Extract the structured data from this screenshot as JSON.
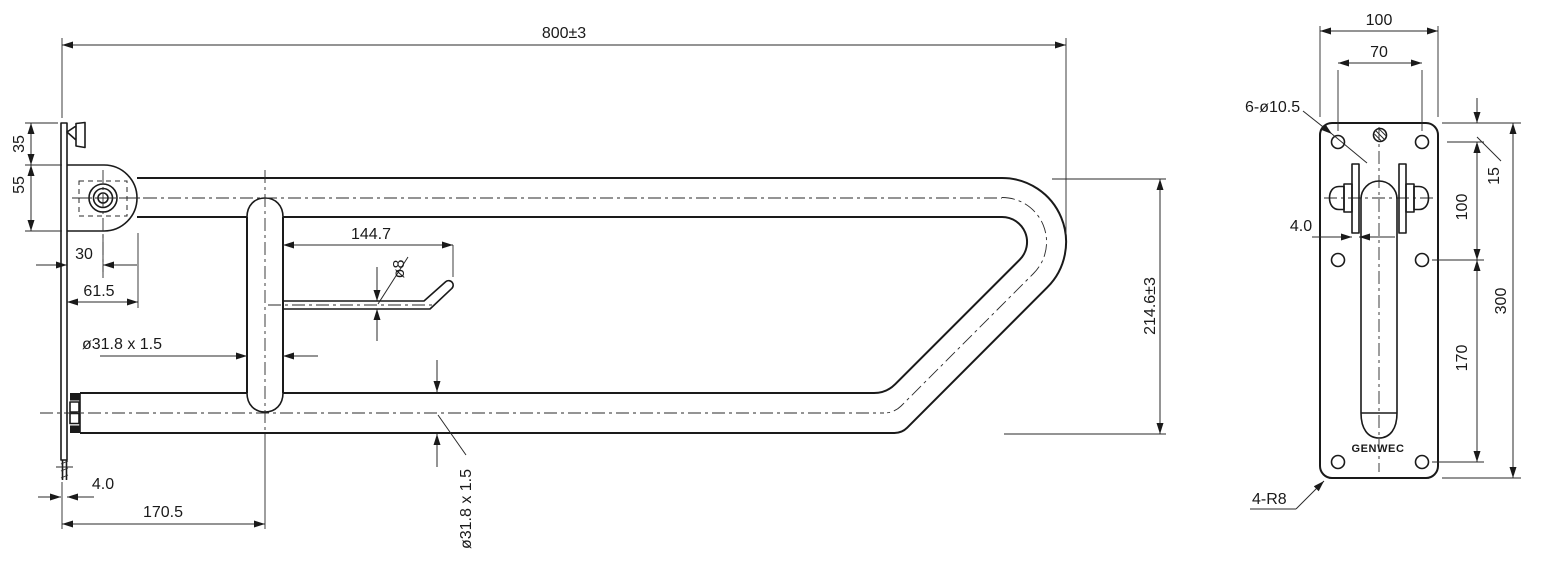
{
  "drawing": {
    "background": "#ffffff",
    "line_color": "#1a1a1a",
    "views": {
      "front": {
        "title": "front-elevation-grab-bar",
        "dimensions": {
          "overall_length": "800±3",
          "plate_top_offset": "35",
          "bracket_height": "55",
          "pivot_offset": "30",
          "bracket_depth": "61.5",
          "holder_length": "144.7",
          "holder_tube_dia": "ø8",
          "support_tube": "ø31.8 x 1.5",
          "drop_height": "214.6±3",
          "flange_thickness": "4.0",
          "support_center_offset": "170.5",
          "main_tube": "ø31.8 x 1.5"
        }
      },
      "side": {
        "title": "side-elevation-mounting-plate",
        "dimensions": {
          "plate_width": "100",
          "hole_spacing_h": "70",
          "mount_holes": "6-ø10.5",
          "leaf_thickness": "4.0",
          "hole_top_offset": "15",
          "hole_spacing_v1": "100",
          "hole_spacing_v2": "170",
          "plate_height": "300",
          "corner_radius": "4-R8"
        },
        "logo": "GENWEC"
      }
    }
  }
}
